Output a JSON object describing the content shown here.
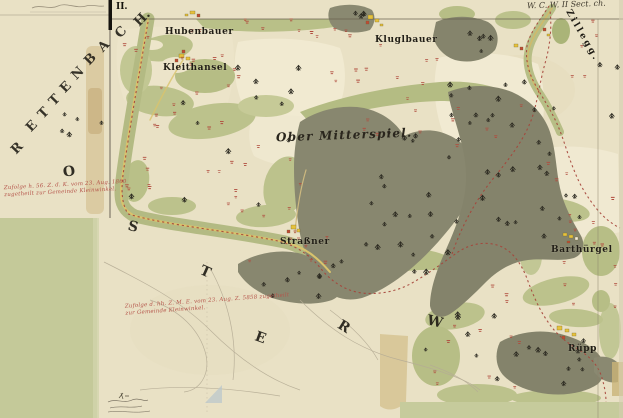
{
  "sheet": {
    "number": "II.",
    "corner_reference": "W. C. W. II Sect. ch."
  },
  "region_names": {
    "rettenbach_letters": [
      "R",
      "E",
      "T",
      "T",
      "E",
      "N",
      "B",
      "A",
      "C",
      "H."
    ],
    "scattered_letters": [
      "O",
      "S",
      "T",
      "E",
      "R",
      "W"
    ],
    "zillegg": "Zillegg."
  },
  "places": [
    {
      "name": "Hubenbauer"
    },
    {
      "name": "Kluglbauer"
    },
    {
      "name": "Kleithansel"
    },
    {
      "name": "Ober Mitterspiel."
    },
    {
      "name": "Straßner"
    },
    {
      "name": "Barthürgel"
    },
    {
      "name": "Rüpp"
    }
  ],
  "annotations": {
    "red_note_1": [
      "Zufolge h. 56. Z. d. K. vom 23. Aug. 1860",
      "zugetheilt zur Gemeinde Kleinwinkel."
    ],
    "red_note_2": [
      "Zufolge d. hh. Z. M. E. vom 23. Aug. Z. 5858 zugetheilt",
      "zur Gemeinde Kleinwinkel."
    ]
  },
  "colors": {
    "paper": "#e9e1c5",
    "field_light": "#f0e9d0",
    "meadow_green": "#bcc28c",
    "forest_olive": "#88876f",
    "boundary_red": "#a6443a",
    "building_yellow": "#e6c23c",
    "building_red": "#bf4a36",
    "corner_block_green": "#c4c999",
    "stain_tan": "#d8c79b"
  }
}
